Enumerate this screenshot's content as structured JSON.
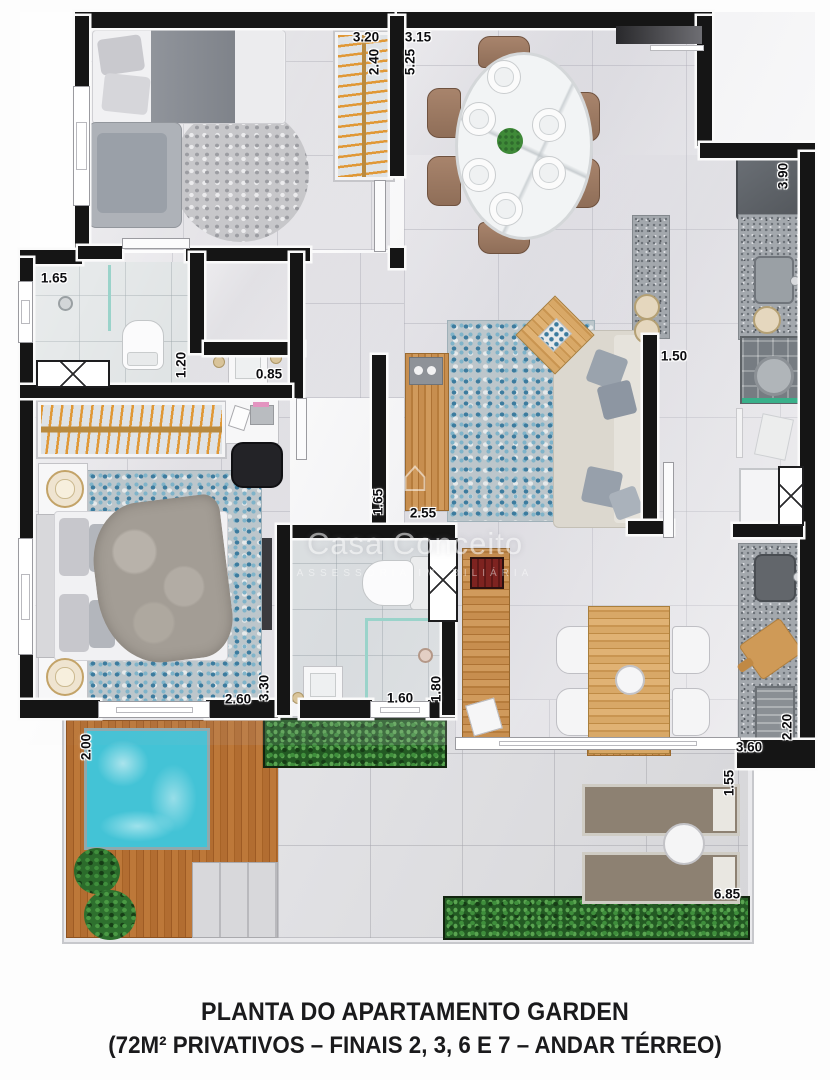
{
  "caption": {
    "line1": "PLANTA DO APARTAMENTO GARDEN",
    "line2": "(72M² PRIVATIVOS – FINAIS 2, 3, 6 E 7 – ANDAR TÉRREO)"
  },
  "watermark": {
    "house_icon": "⌂",
    "name": "Casa Conceito",
    "subtitle": "ASSESSORIA IMOBILIÁRIA"
  },
  "dimensions": {
    "closet1_width": "3.20",
    "closet1_depth": "2.40",
    "living_dining_width": "3.15",
    "living_dining_length": "5.25",
    "kitchen_counter_length": "3.90",
    "bath1_shower_width": "1.65",
    "bath1_width": "1.20",
    "lavatory_width": "0.85",
    "hall_width": "1.50",
    "tv_rack_length": "2.55",
    "living_side_depth": "1.65",
    "bedroom2_width": "2.60",
    "bedroom2_length": "3.30",
    "bath2_width": "1.60",
    "bath2_length": "1.80",
    "deck_width": "2.00",
    "service_counter_length": "3.60",
    "service_width": "2.20",
    "garden_strip_depth": "1.55",
    "garden_length": "6.85"
  }
}
